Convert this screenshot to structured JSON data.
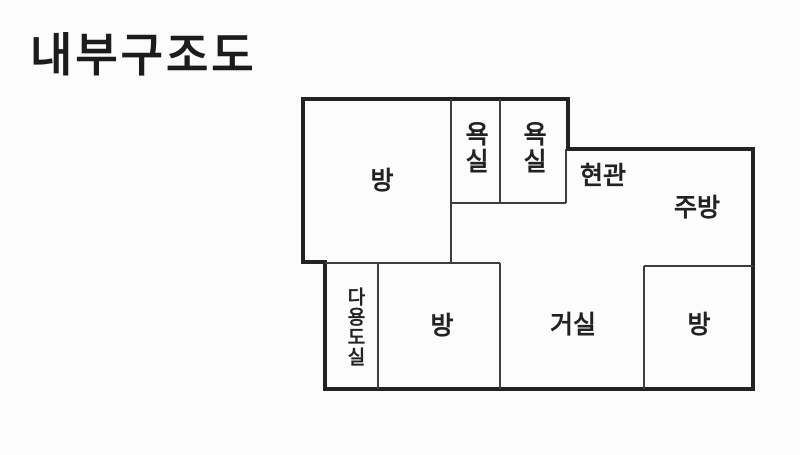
{
  "title": "내부구조도",
  "floorplan": {
    "outer_wall_color": "#232323",
    "inner_wall_color": "#3d3d3d",
    "background_color": "#fcfcfc",
    "rooms": [
      {
        "id": "room-top-left",
        "label": "방",
        "orientation": "horizontal"
      },
      {
        "id": "bathroom-1",
        "label": "욕실",
        "orientation": "vertical"
      },
      {
        "id": "bathroom-2",
        "label": "욕실",
        "orientation": "vertical"
      },
      {
        "id": "entrance",
        "label": "현관",
        "orientation": "horizontal"
      },
      {
        "id": "kitchen",
        "label": "주방",
        "orientation": "horizontal"
      },
      {
        "id": "utility-room",
        "label": "다용도실",
        "orientation": "vertical"
      },
      {
        "id": "room-middle",
        "label": "방",
        "orientation": "horizontal"
      },
      {
        "id": "living-room",
        "label": "거실",
        "orientation": "horizontal"
      },
      {
        "id": "room-bottom-right",
        "label": "방",
        "orientation": "horizontal"
      }
    ]
  }
}
